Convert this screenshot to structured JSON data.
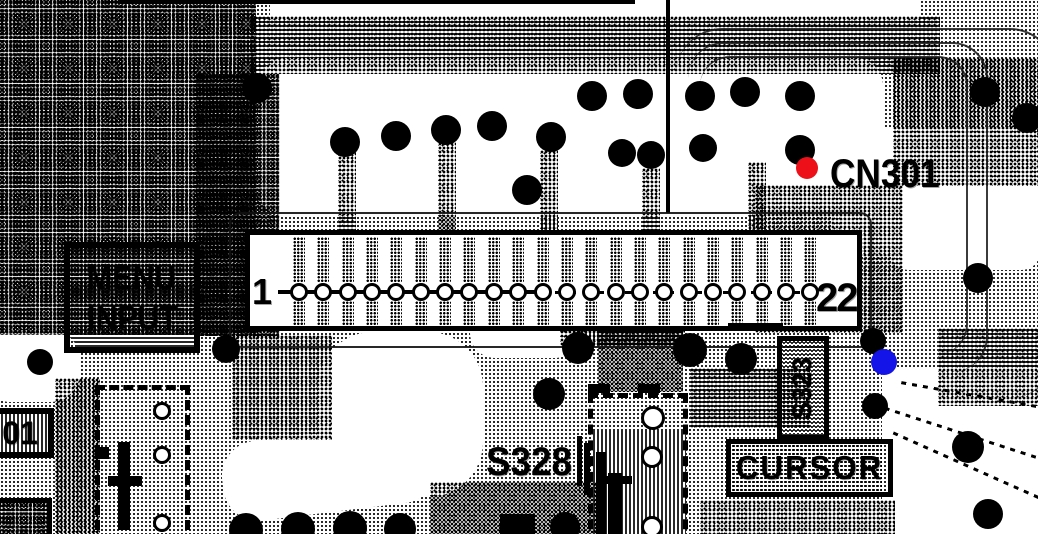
{
  "meta": {
    "type": "scanned-pcb-layout-diagram"
  },
  "labels": {
    "connector_name": "CN301",
    "menu_input": [
      "MENU",
      "INPUT"
    ],
    "cursor": "CURSOR",
    "switch_s328": "S328",
    "switch_s323": "S323",
    "partial_left_label": "01",
    "pin_first": "1",
    "pin_last": "22"
  },
  "connector": {
    "pin_count": 22,
    "pin_start_x": 299,
    "pin_spacing": 24.35,
    "pin_center_y": 292,
    "pin_radius": 9
  },
  "markers": [
    {
      "name": "red-marker",
      "color": "#ee1018",
      "x": 807,
      "y": 168,
      "r": 11
    },
    {
      "name": "blue-marker",
      "color": "#1414e8",
      "x": 884,
      "y": 362,
      "r": 13
    }
  ],
  "pads": [
    {
      "x": 257,
      "y": 88,
      "r": 15
    },
    {
      "x": 345,
      "y": 142,
      "r": 15
    },
    {
      "x": 396,
      "y": 136,
      "r": 15
    },
    {
      "x": 446,
      "y": 130,
      "r": 15
    },
    {
      "x": 492,
      "y": 126,
      "r": 15
    },
    {
      "x": 551,
      "y": 137,
      "r": 15
    },
    {
      "x": 527,
      "y": 190,
      "r": 15
    },
    {
      "x": 592,
      "y": 96,
      "r": 15
    },
    {
      "x": 638,
      "y": 94,
      "r": 15
    },
    {
      "x": 700,
      "y": 96,
      "r": 15
    },
    {
      "x": 745,
      "y": 92,
      "r": 15
    },
    {
      "x": 800,
      "y": 96,
      "r": 15
    },
    {
      "x": 622,
      "y": 153,
      "r": 14
    },
    {
      "x": 651,
      "y": 155,
      "r": 14
    },
    {
      "x": 703,
      "y": 148,
      "r": 14
    },
    {
      "x": 800,
      "y": 150,
      "r": 15
    },
    {
      "x": 985,
      "y": 92,
      "r": 15
    },
    {
      "x": 1027,
      "y": 118,
      "r": 15
    },
    {
      "x": 978,
      "y": 278,
      "r": 15
    },
    {
      "x": 873,
      "y": 341,
      "r": 13
    },
    {
      "x": 875,
      "y": 406,
      "r": 13
    },
    {
      "x": 968,
      "y": 447,
      "r": 16
    },
    {
      "x": 988,
      "y": 514,
      "r": 15
    },
    {
      "x": 226,
      "y": 349,
      "r": 14
    },
    {
      "x": 40,
      "y": 362,
      "r": 13
    },
    {
      "x": 578,
      "y": 348,
      "r": 16
    },
    {
      "x": 690,
      "y": 350,
      "r": 17
    },
    {
      "x": 741,
      "y": 359,
      "r": 16
    },
    {
      "x": 549,
      "y": 394,
      "r": 16
    },
    {
      "x": 246,
      "y": 530,
      "r": 17
    },
    {
      "x": 298,
      "y": 529,
      "r": 17
    },
    {
      "x": 350,
      "y": 528,
      "r": 17
    },
    {
      "x": 400,
      "y": 529,
      "r": 16
    },
    {
      "x": 565,
      "y": 527,
      "r": 15
    }
  ],
  "rings": [
    {
      "x": 162,
      "y": 411,
      "r": 9
    },
    {
      "x": 162,
      "y": 455,
      "r": 9
    },
    {
      "x": 162,
      "y": 523,
      "r": 9
    },
    {
      "x": 653,
      "y": 418,
      "r": 12
    },
    {
      "x": 652,
      "y": 457,
      "r": 11
    },
    {
      "x": 652,
      "y": 527,
      "r": 11
    }
  ]
}
